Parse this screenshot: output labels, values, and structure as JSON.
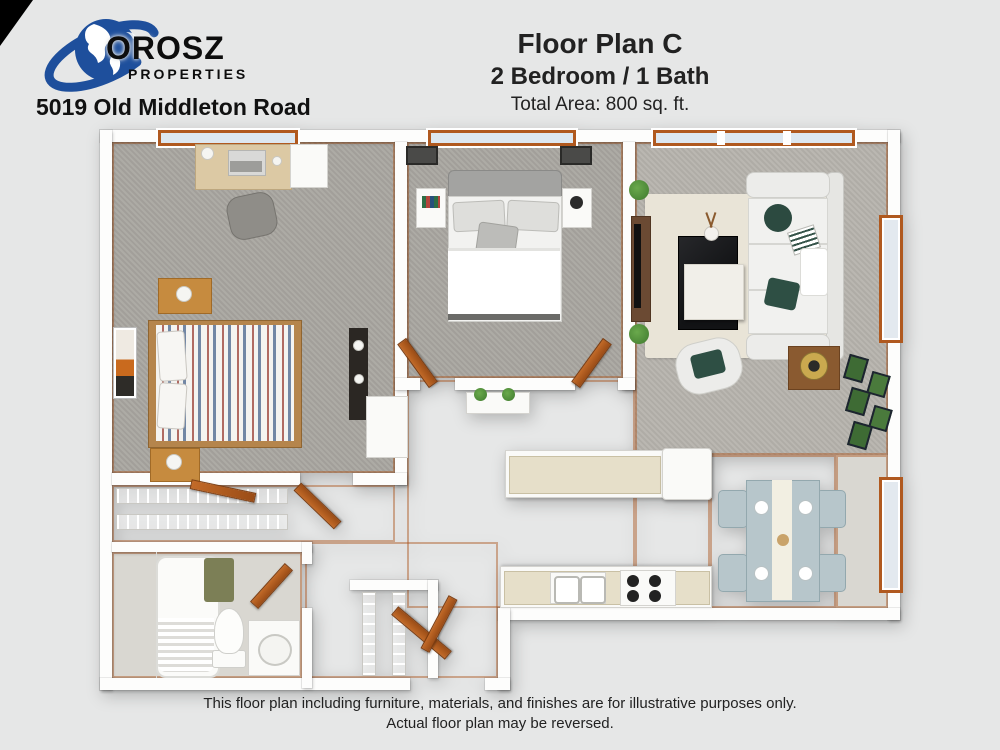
{
  "branding": {
    "logo_text": "OROSZ",
    "logo_subtext": "PROPERTIES",
    "address": "5019 Old Middleton Road"
  },
  "header": {
    "title": "Floor Plan C",
    "subtitle": "2 Bedroom / 1 Bath",
    "area": "Total Area: 800 sq. ft."
  },
  "footer": {
    "line1": "This floor plan including furniture, materials, and finishes are for illustrative purposes only.",
    "line2": "Actual floor plan may be reversed."
  },
  "colors": {
    "background": "#e6e7e7",
    "logo_blue": "#1e4f9c",
    "accent_orange": "#b0591f",
    "wall_white": "#fdfdfc",
    "carpet_gray": "#a9a6a0",
    "living_carpet": "#b6b3ad",
    "wood_floor": "#97918a",
    "area_rug": "#e9e4d7",
    "pillow_green": "#2c4a40",
    "dining_set_blue": "#b7c6cb",
    "countertop_beige": "#e6dfc9",
    "coffee_table_black": "#1b1c1e",
    "bath_mat_olive": "#7c7f56"
  }
}
